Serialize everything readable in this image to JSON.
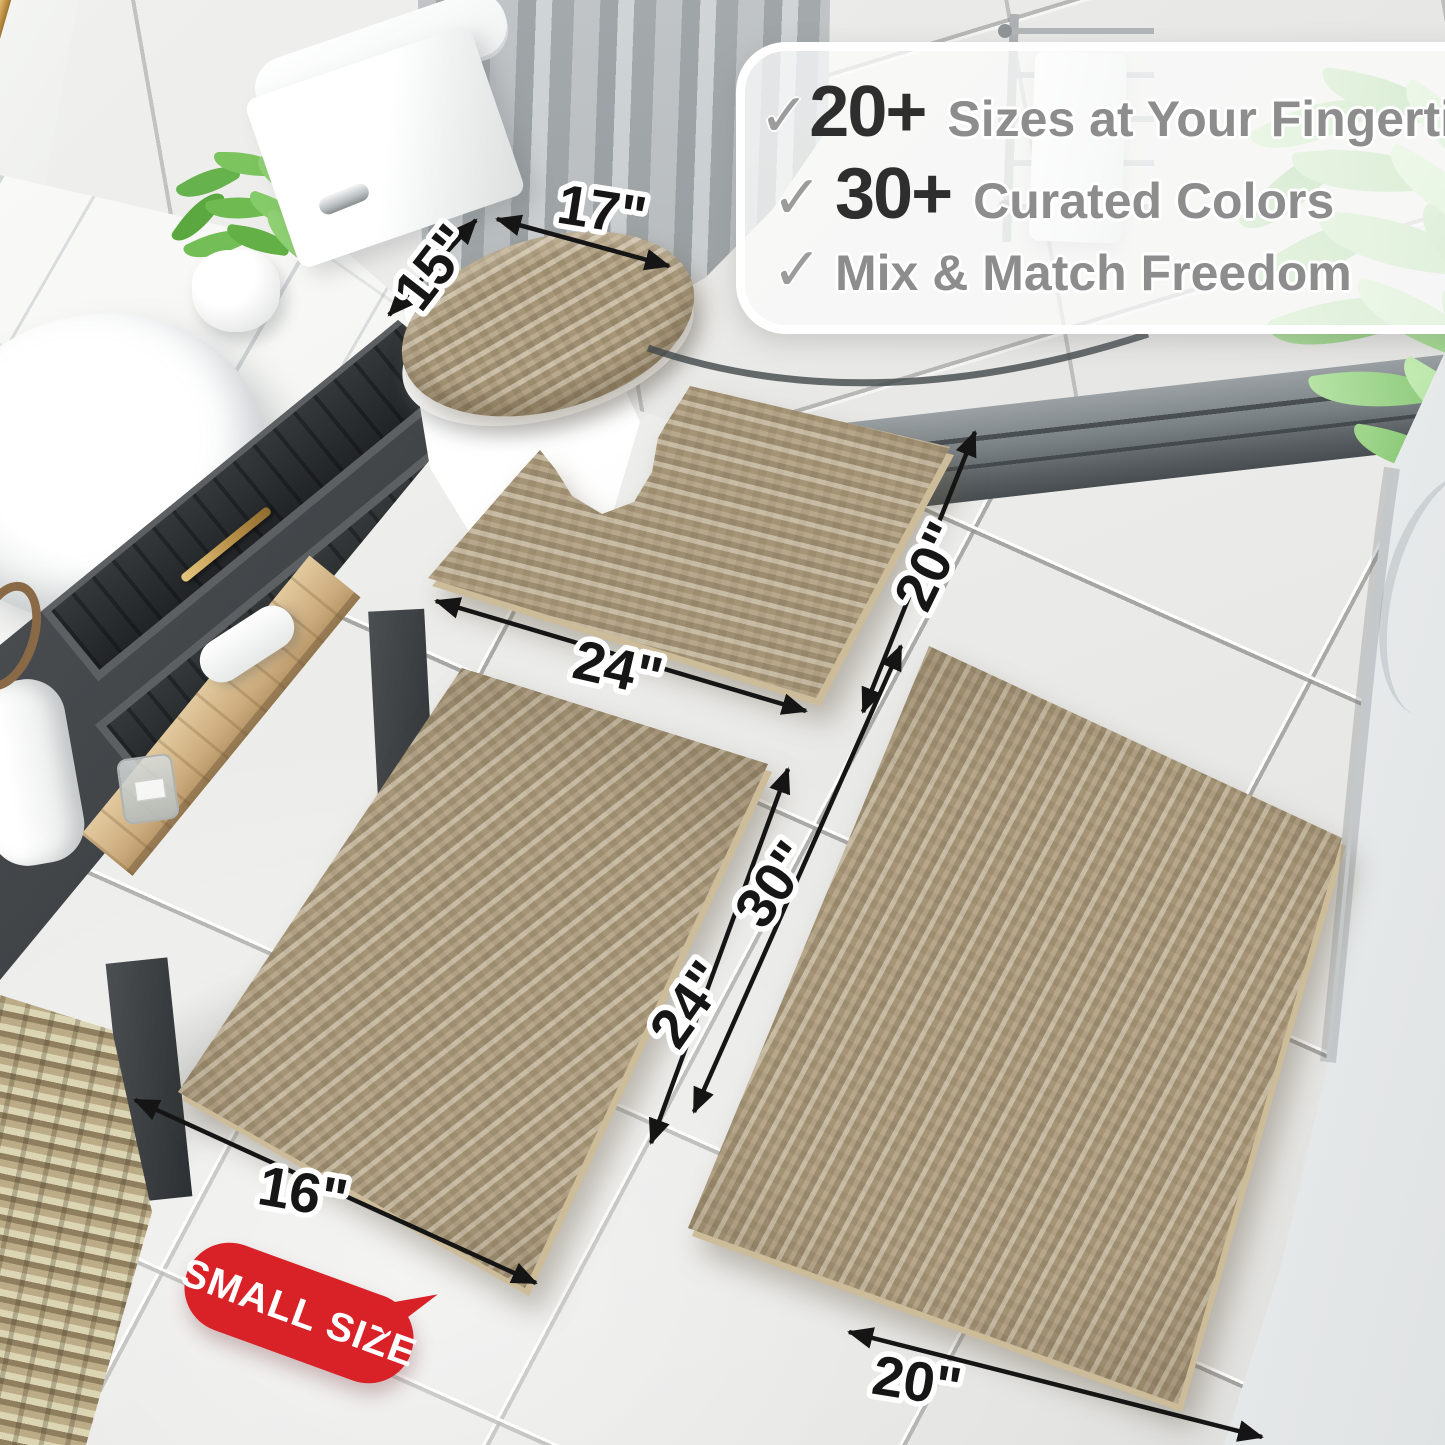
{
  "callout": {
    "check_glyph": "✓",
    "items": [
      {
        "number": "20+",
        "text": "Sizes at Your Fingertips"
      },
      {
        "number": "30+",
        "text": "Curated Colors"
      },
      {
        "number": "",
        "text": "Mix & Match Freedom"
      }
    ]
  },
  "dimensions": {
    "lid_width": "17\"",
    "lid_depth": "15\"",
    "contour_width": "24\"",
    "contour_depth": "20\"",
    "runner_length": "30\"",
    "small_length": "24\"",
    "small_width": "16\"",
    "runner_width": "20\""
  },
  "badge": {
    "label": "SMALL SIZE"
  },
  "colors": {
    "rug_beige": "#b3a283",
    "badge_red": "#d92128",
    "number_dark": "#2e2e2e",
    "feature_gray": "#8d8d8d",
    "check_gray": "#9c9c9c",
    "arrow_black": "#151515",
    "gold_accent": "#c9a35f",
    "floor_tile": "#ededeb",
    "wall_tile": "#e7e7e5",
    "curtain_gray": "#9aa0a3",
    "ledge_gray": "#575d60"
  }
}
